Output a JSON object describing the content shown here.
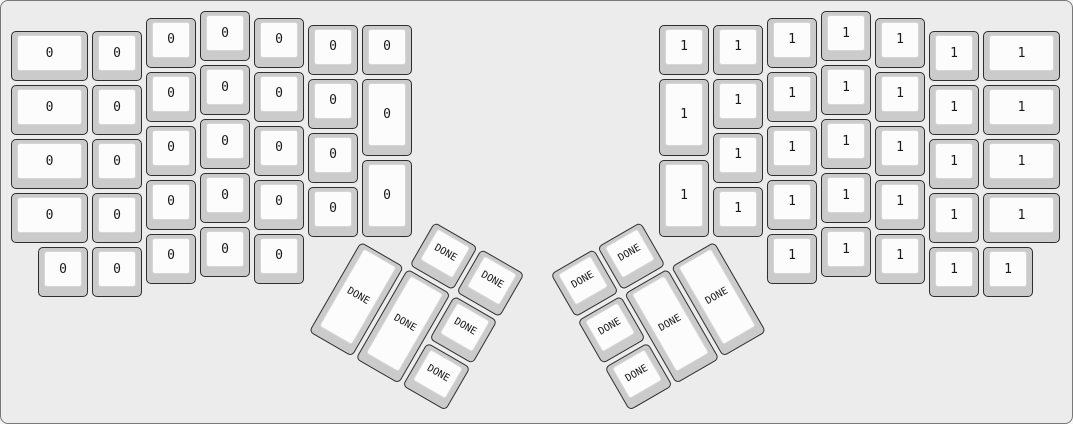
{
  "canvas": {
    "width_px": 1073,
    "height_px": 424,
    "background_color": "#ececec",
    "border_color": "#787878"
  },
  "key_style": {
    "cap_color": "#cbcbcb",
    "cap_border_color": "#2f2f2f",
    "face_color": "#fcfcfc",
    "face_border_color": "#d6d6d6",
    "label_color": "#1a1a1a",
    "unit_px": 54,
    "key_inset_px": 2
  },
  "keyboard": {
    "type": "ergodox-split-layout",
    "layer_labels": {
      "left_half": "0",
      "right_half": "1",
      "thumb_keys": "DONE"
    },
    "groups": [
      {
        "name": "left-main",
        "rotation_deg": 0,
        "rx_px": 8,
        "ry_px": 8,
        "keys": [
          {
            "x": 0,
            "y": 0.375,
            "w": 1.5,
            "h": 1,
            "label": "0"
          },
          {
            "x": 0,
            "y": 1.375,
            "w": 1.5,
            "h": 1,
            "label": "0"
          },
          {
            "x": 0,
            "y": 2.375,
            "w": 1.5,
            "h": 1,
            "label": "0"
          },
          {
            "x": 0,
            "y": 3.375,
            "w": 1.5,
            "h": 1,
            "label": "0"
          },
          {
            "x": 1.5,
            "y": 0.375,
            "w": 1,
            "h": 1,
            "label": "0"
          },
          {
            "x": 1.5,
            "y": 1.375,
            "w": 1,
            "h": 1,
            "label": "0"
          },
          {
            "x": 1.5,
            "y": 2.375,
            "w": 1,
            "h": 1,
            "label": "0"
          },
          {
            "x": 1.5,
            "y": 3.375,
            "w": 1,
            "h": 1,
            "label": "0"
          },
          {
            "x": 0.5,
            "y": 4.375,
            "w": 1,
            "h": 1,
            "label": "0"
          },
          {
            "x": 1.5,
            "y": 4.375,
            "w": 1,
            "h": 1,
            "label": "0"
          },
          {
            "x": 2.5,
            "y": 0.125,
            "w": 1,
            "h": 1,
            "label": "0"
          },
          {
            "x": 2.5,
            "y": 1.125,
            "w": 1,
            "h": 1,
            "label": "0"
          },
          {
            "x": 2.5,
            "y": 2.125,
            "w": 1,
            "h": 1,
            "label": "0"
          },
          {
            "x": 2.5,
            "y": 3.125,
            "w": 1,
            "h": 1,
            "label": "0"
          },
          {
            "x": 2.5,
            "y": 4.125,
            "w": 1,
            "h": 1,
            "label": "0"
          },
          {
            "x": 3.5,
            "y": 0,
            "w": 1,
            "h": 1,
            "label": "0"
          },
          {
            "x": 3.5,
            "y": 1,
            "w": 1,
            "h": 1,
            "label": "0"
          },
          {
            "x": 3.5,
            "y": 2,
            "w": 1,
            "h": 1,
            "label": "0"
          },
          {
            "x": 3.5,
            "y": 3,
            "w": 1,
            "h": 1,
            "label": "0"
          },
          {
            "x": 3.5,
            "y": 4,
            "w": 1,
            "h": 1,
            "label": "0"
          },
          {
            "x": 4.5,
            "y": 0.125,
            "w": 1,
            "h": 1,
            "label": "0"
          },
          {
            "x": 4.5,
            "y": 1.125,
            "w": 1,
            "h": 1,
            "label": "0"
          },
          {
            "x": 4.5,
            "y": 2.125,
            "w": 1,
            "h": 1,
            "label": "0"
          },
          {
            "x": 4.5,
            "y": 3.125,
            "w": 1,
            "h": 1,
            "label": "0"
          },
          {
            "x": 4.5,
            "y": 4.125,
            "w": 1,
            "h": 1,
            "label": "0"
          },
          {
            "x": 5.5,
            "y": 0.25,
            "w": 1,
            "h": 1,
            "label": "0"
          },
          {
            "x": 5.5,
            "y": 1.25,
            "w": 1,
            "h": 1,
            "label": "0"
          },
          {
            "x": 5.5,
            "y": 2.25,
            "w": 1,
            "h": 1,
            "label": "0"
          },
          {
            "x": 5.5,
            "y": 3.25,
            "w": 1,
            "h": 1,
            "label": "0"
          },
          {
            "x": 6.5,
            "y": 0.25,
            "w": 1,
            "h": 1,
            "label": "0"
          },
          {
            "x": 6.5,
            "y": 1.25,
            "w": 1,
            "h": 1.5,
            "label": "0"
          },
          {
            "x": 6.5,
            "y": 2.75,
            "w": 1,
            "h": 1.5,
            "label": "0"
          }
        ]
      },
      {
        "name": "right-main",
        "rotation_deg": 0,
        "rx_px": 8,
        "ry_px": 8,
        "keys": [
          {
            "x": 18,
            "y": 0.375,
            "w": 1.5,
            "h": 1,
            "label": "1"
          },
          {
            "x": 18,
            "y": 1.375,
            "w": 1.5,
            "h": 1,
            "label": "1"
          },
          {
            "x": 18,
            "y": 2.375,
            "w": 1.5,
            "h": 1,
            "label": "1"
          },
          {
            "x": 18,
            "y": 3.375,
            "w": 1.5,
            "h": 1,
            "label": "1"
          },
          {
            "x": 17,
            "y": 0.375,
            "w": 1,
            "h": 1,
            "label": "1"
          },
          {
            "x": 17,
            "y": 1.375,
            "w": 1,
            "h": 1,
            "label": "1"
          },
          {
            "x": 17,
            "y": 2.375,
            "w": 1,
            "h": 1,
            "label": "1"
          },
          {
            "x": 17,
            "y": 3.375,
            "w": 1,
            "h": 1,
            "label": "1"
          },
          {
            "x": 17,
            "y": 4.375,
            "w": 1,
            "h": 1,
            "label": "1"
          },
          {
            "x": 18,
            "y": 4.375,
            "w": 1,
            "h": 1,
            "label": "1"
          },
          {
            "x": 16,
            "y": 0.125,
            "w": 1,
            "h": 1,
            "label": "1"
          },
          {
            "x": 16,
            "y": 1.125,
            "w": 1,
            "h": 1,
            "label": "1"
          },
          {
            "x": 16,
            "y": 2.125,
            "w": 1,
            "h": 1,
            "label": "1"
          },
          {
            "x": 16,
            "y": 3.125,
            "w": 1,
            "h": 1,
            "label": "1"
          },
          {
            "x": 16,
            "y": 4.125,
            "w": 1,
            "h": 1,
            "label": "1"
          },
          {
            "x": 15,
            "y": 0,
            "w": 1,
            "h": 1,
            "label": "1"
          },
          {
            "x": 15,
            "y": 1,
            "w": 1,
            "h": 1,
            "label": "1"
          },
          {
            "x": 15,
            "y": 2,
            "w": 1,
            "h": 1,
            "label": "1"
          },
          {
            "x": 15,
            "y": 3,
            "w": 1,
            "h": 1,
            "label": "1"
          },
          {
            "x": 15,
            "y": 4,
            "w": 1,
            "h": 1,
            "label": "1"
          },
          {
            "x": 14,
            "y": 0.125,
            "w": 1,
            "h": 1,
            "label": "1"
          },
          {
            "x": 14,
            "y": 1.125,
            "w": 1,
            "h": 1,
            "label": "1"
          },
          {
            "x": 14,
            "y": 2.125,
            "w": 1,
            "h": 1,
            "label": "1"
          },
          {
            "x": 14,
            "y": 3.125,
            "w": 1,
            "h": 1,
            "label": "1"
          },
          {
            "x": 14,
            "y": 4.125,
            "w": 1,
            "h": 1,
            "label": "1"
          },
          {
            "x": 13,
            "y": 0.25,
            "w": 1,
            "h": 1,
            "label": "1"
          },
          {
            "x": 13,
            "y": 1.25,
            "w": 1,
            "h": 1,
            "label": "1"
          },
          {
            "x": 13,
            "y": 2.25,
            "w": 1,
            "h": 1,
            "label": "1"
          },
          {
            "x": 13,
            "y": 3.25,
            "w": 1,
            "h": 1,
            "label": "1"
          },
          {
            "x": 12,
            "y": 0.25,
            "w": 1,
            "h": 1,
            "label": "1"
          },
          {
            "x": 12,
            "y": 1.25,
            "w": 1,
            "h": 1.5,
            "label": "1"
          },
          {
            "x": 12,
            "y": 2.75,
            "w": 1,
            "h": 1.5,
            "label": "1"
          }
        ]
      },
      {
        "name": "left-thumb",
        "rotation_deg": 30,
        "rx_px": 359,
        "ry_px": 237.5,
        "keys": [
          {
            "x": 1,
            "y": -1,
            "w": 1,
            "h": 1,
            "label": "DONE"
          },
          {
            "x": 2,
            "y": -1,
            "w": 1,
            "h": 1,
            "label": "DONE"
          },
          {
            "x": 0,
            "y": 0,
            "w": 1,
            "h": 2,
            "label": "DONE"
          },
          {
            "x": 1,
            "y": 0,
            "w": 1,
            "h": 2,
            "label": "DONE"
          },
          {
            "x": 2,
            "y": 0,
            "w": 1,
            "h": 1,
            "label": "DONE"
          },
          {
            "x": 2,
            "y": 1,
            "w": 1,
            "h": 1,
            "label": "DONE"
          }
        ]
      },
      {
        "name": "right-thumb",
        "rotation_deg": -30,
        "rx_px": 714,
        "ry_px": 237.5,
        "keys": [
          {
            "x": -2,
            "y": -1,
            "w": 1,
            "h": 1,
            "label": "DONE"
          },
          {
            "x": -3,
            "y": -1,
            "w": 1,
            "h": 1,
            "label": "DONE"
          },
          {
            "x": -1,
            "y": 0,
            "w": 1,
            "h": 2,
            "label": "DONE"
          },
          {
            "x": -2,
            "y": 0,
            "w": 1,
            "h": 2,
            "label": "DONE"
          },
          {
            "x": -3,
            "y": 0,
            "w": 1,
            "h": 1,
            "label": "DONE"
          },
          {
            "x": -3,
            "y": 1,
            "w": 1,
            "h": 1,
            "label": "DONE"
          }
        ]
      }
    ]
  }
}
